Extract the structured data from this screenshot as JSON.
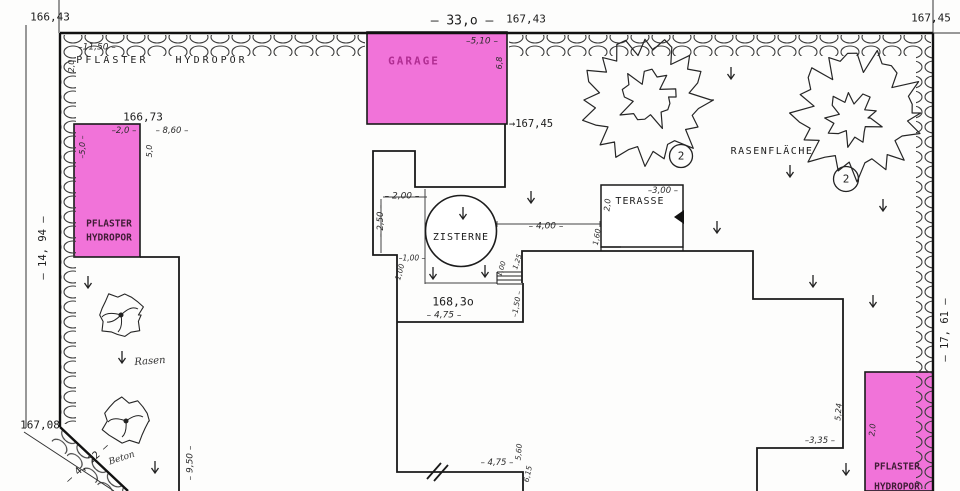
{
  "colors": {
    "paving_fill": "#f173d9",
    "paving_label": "#b02d92",
    "ink": "#1c1c1c"
  },
  "labels": [
    {
      "id": "elev-166-43",
      "text": "166,43",
      "x": 50,
      "y": 17,
      "size": 11,
      "style": "print"
    },
    {
      "id": "dim-11-50",
      "text": "–11,50 –",
      "x": 97,
      "y": 48,
      "size": 9,
      "style": "hand"
    },
    {
      "id": "dim-2-0-top",
      "text": "2,0",
      "x": 72,
      "y": 66,
      "rot": -90,
      "size": 8,
      "style": "hand"
    },
    {
      "id": "lbl-pflaster-hydropor-top",
      "text": "PFLASTER   HYDROPOR",
      "x": 162,
      "y": 61,
      "size": 10,
      "ls": 3,
      "style": "print"
    },
    {
      "id": "elev-166-73",
      "text": "166,73",
      "x": 143,
      "y": 117,
      "size": 11,
      "style": "print"
    },
    {
      "id": "dim-2-0-left",
      "text": "–2,0 –",
      "x": 124,
      "y": 131,
      "size": 8.5,
      "style": "hand"
    },
    {
      "id": "dim-8-60",
      "text": "– 8,60 –",
      "x": 172,
      "y": 131,
      "size": 8.5,
      "style": "hand"
    },
    {
      "id": "dim-5-0-inner",
      "text": "–5,0 –",
      "x": 83,
      "y": 147,
      "rot": -90,
      "size": 8,
      "style": "hand"
    },
    {
      "id": "dim-5-0-right",
      "text": "5,0",
      "x": 150,
      "y": 151,
      "rot": -90,
      "size": 8,
      "style": "hand"
    },
    {
      "id": "lbl-pflaster-left-1",
      "text": "PFLASTER",
      "x": 109,
      "y": 224,
      "size": 9.5,
      "style": "dark"
    },
    {
      "id": "lbl-pflaster-left-2",
      "text": "HYDROPOR",
      "x": 109,
      "y": 238,
      "size": 9.5,
      "style": "dark"
    },
    {
      "id": "dim-14-94",
      "text": "– 14, 94 –",
      "x": 43,
      "y": 248,
      "rot": -90,
      "size": 10.5,
      "style": "print"
    },
    {
      "id": "lbl-garage",
      "text": "GARAGE",
      "x": 414,
      "y": 61,
      "size": 11,
      "ls": 2,
      "style": "pinktext"
    },
    {
      "id": "dim-33-0",
      "text": "– 33,o –",
      "x": 462,
      "y": 21,
      "size": 13,
      "style": "print"
    },
    {
      "id": "elev-167-43",
      "text": "167,43",
      "x": 526,
      "y": 19,
      "size": 11,
      "style": "print"
    },
    {
      "id": "dim-5-10",
      "text": "–5,10 –",
      "x": 482,
      "y": 42,
      "size": 9,
      "style": "hand"
    },
    {
      "id": "dim-6-8",
      "text": "6,8",
      "x": 500,
      "y": 63,
      "rot": -90,
      "size": 8,
      "style": "hand"
    },
    {
      "id": "elev-167-45-garage",
      "text": "→167,45",
      "x": 531,
      "y": 124,
      "size": 10.5,
      "style": "print"
    },
    {
      "id": "elev-167-45-top",
      "text": "167,45",
      "x": 931,
      "y": 18,
      "size": 11,
      "style": "print"
    },
    {
      "id": "lbl-rasenflaeche",
      "text": "RASENFLÄCHE",
      "x": 772,
      "y": 152,
      "size": 10,
      "ls": 1.5,
      "style": "print"
    },
    {
      "id": "marker-tree-1",
      "text": "2",
      "x": 681,
      "y": 156,
      "size": 11,
      "style": "print"
    },
    {
      "id": "marker-tree-2",
      "text": "2",
      "x": 846,
      "y": 179,
      "size": 11,
      "style": "print"
    },
    {
      "id": "dim-2-00",
      "text": "– 2,00 –",
      "x": 402,
      "y": 197,
      "size": 9,
      "style": "hand"
    },
    {
      "id": "dim-2-50",
      "text": "– 2,50 –",
      "x": 381,
      "y": 221,
      "rot": -90,
      "size": 8.5,
      "style": "hand"
    },
    {
      "id": "dim-1-00-a",
      "text": "–1,00 –",
      "x": 412,
      "y": 258,
      "size": 7.5,
      "style": "hand"
    },
    {
      "id": "dim-1-00-b",
      "text": "1,00",
      "x": 400,
      "y": 272,
      "rot": -75,
      "size": 7.5,
      "style": "hand"
    },
    {
      "id": "lbl-zisterne",
      "text": "ZISTERNE",
      "x": 461,
      "y": 238,
      "size": 10,
      "ls": 1,
      "style": "print"
    },
    {
      "id": "dim-4-00",
      "text": "– 4,00 –",
      "x": 546,
      "y": 227,
      "size": 9,
      "style": "hand"
    },
    {
      "id": "dim-1-60",
      "text": "1,60",
      "x": 597,
      "y": 237,
      "rot": -80,
      "size": 7.5,
      "style": "hand"
    },
    {
      "id": "dim-2-0-terasse",
      "text": "2,0",
      "x": 608,
      "y": 205,
      "rot": -85,
      "size": 8,
      "style": "hand"
    },
    {
      "id": "lbl-terasse",
      "text": "TERASSE",
      "x": 640,
      "y": 202,
      "size": 10,
      "ls": 1,
      "style": "print"
    },
    {
      "id": "dim-3-00",
      "text": "–3,00 –",
      "x": 663,
      "y": 191,
      "size": 8.5,
      "style": "hand"
    },
    {
      "id": "dim-1-00-stairs",
      "text": "1,00",
      "x": 502,
      "y": 269,
      "rot": -72,
      "size": 7,
      "style": "hand"
    },
    {
      "id": "dim-1-25",
      "text": "1,25",
      "x": 518,
      "y": 262,
      "rot": -72,
      "size": 7,
      "style": "hand"
    },
    {
      "id": "dim-1-50",
      "text": "–1,50 –",
      "x": 517,
      "y": 304,
      "rot": -80,
      "size": 7.5,
      "style": "hand"
    },
    {
      "id": "elev-168-30",
      "text": "168,3o",
      "x": 453,
      "y": 302,
      "size": 11.5,
      "style": "print"
    },
    {
      "id": "dim-4-75-top",
      "text": "– 4,75 –",
      "x": 444,
      "y": 316,
      "size": 9,
      "style": "hand"
    },
    {
      "id": "hand-rasen",
      "text": "Rasen",
      "x": 150,
      "y": 362,
      "rot": -4,
      "size": 10,
      "style": "cursive"
    },
    {
      "id": "dim-9-50",
      "text": "– 9,50 –",
      "x": 191,
      "y": 463,
      "rot": -90,
      "size": 9,
      "style": "hand"
    },
    {
      "id": "elev-167-08",
      "text": "167,08",
      "x": 40,
      "y": 425,
      "size": 11,
      "style": "print"
    },
    {
      "id": "dim-4-22",
      "text": "– 4, 22 –",
      "x": 88,
      "y": 464,
      "rot": -42,
      "size": 10,
      "style": "print"
    },
    {
      "id": "hand-beton",
      "text": "Beton",
      "x": 122,
      "y": 459,
      "rot": -18,
      "size": 9,
      "style": "cursive"
    },
    {
      "id": "dim-4-75-bottom",
      "text": "– 4,75 –",
      "x": 497,
      "y": 463,
      "size": 8.5,
      "style": "hand"
    },
    {
      "id": "dim-5-60",
      "text": "5,60",
      "x": 519,
      "y": 452,
      "rot": -85,
      "size": 7.5,
      "style": "hand"
    },
    {
      "id": "dim-6-15",
      "text": "6,15",
      "x": 528,
      "y": 474,
      "rot": -78,
      "size": 7.5,
      "style": "hand"
    },
    {
      "id": "dim-3-35",
      "text": "–3,35 –",
      "x": 820,
      "y": 441,
      "size": 8.5,
      "style": "hand"
    },
    {
      "id": "dim-5-24",
      "text": "5,24",
      "x": 839,
      "y": 412,
      "rot": -85,
      "size": 8,
      "style": "hand"
    },
    {
      "id": "dim-2-0-br",
      "text": "2,0",
      "x": 873,
      "y": 430,
      "rot": -85,
      "size": 8,
      "style": "hand"
    },
    {
      "id": "dim-17-61",
      "text": "– 17, 61 –",
      "x": 945,
      "y": 330,
      "rot": -90,
      "size": 10.5,
      "style": "print"
    },
    {
      "id": "lbl-pflaster-br",
      "text": "PFLASTER",
      "x": 897,
      "y": 467,
      "size": 9.5,
      "style": "dark"
    },
    {
      "id": "lbl-hydropor-br",
      "text": "HYDROPOR",
      "x": 897,
      "y": 487,
      "size": 9.5,
      "style": "dark"
    }
  ]
}
